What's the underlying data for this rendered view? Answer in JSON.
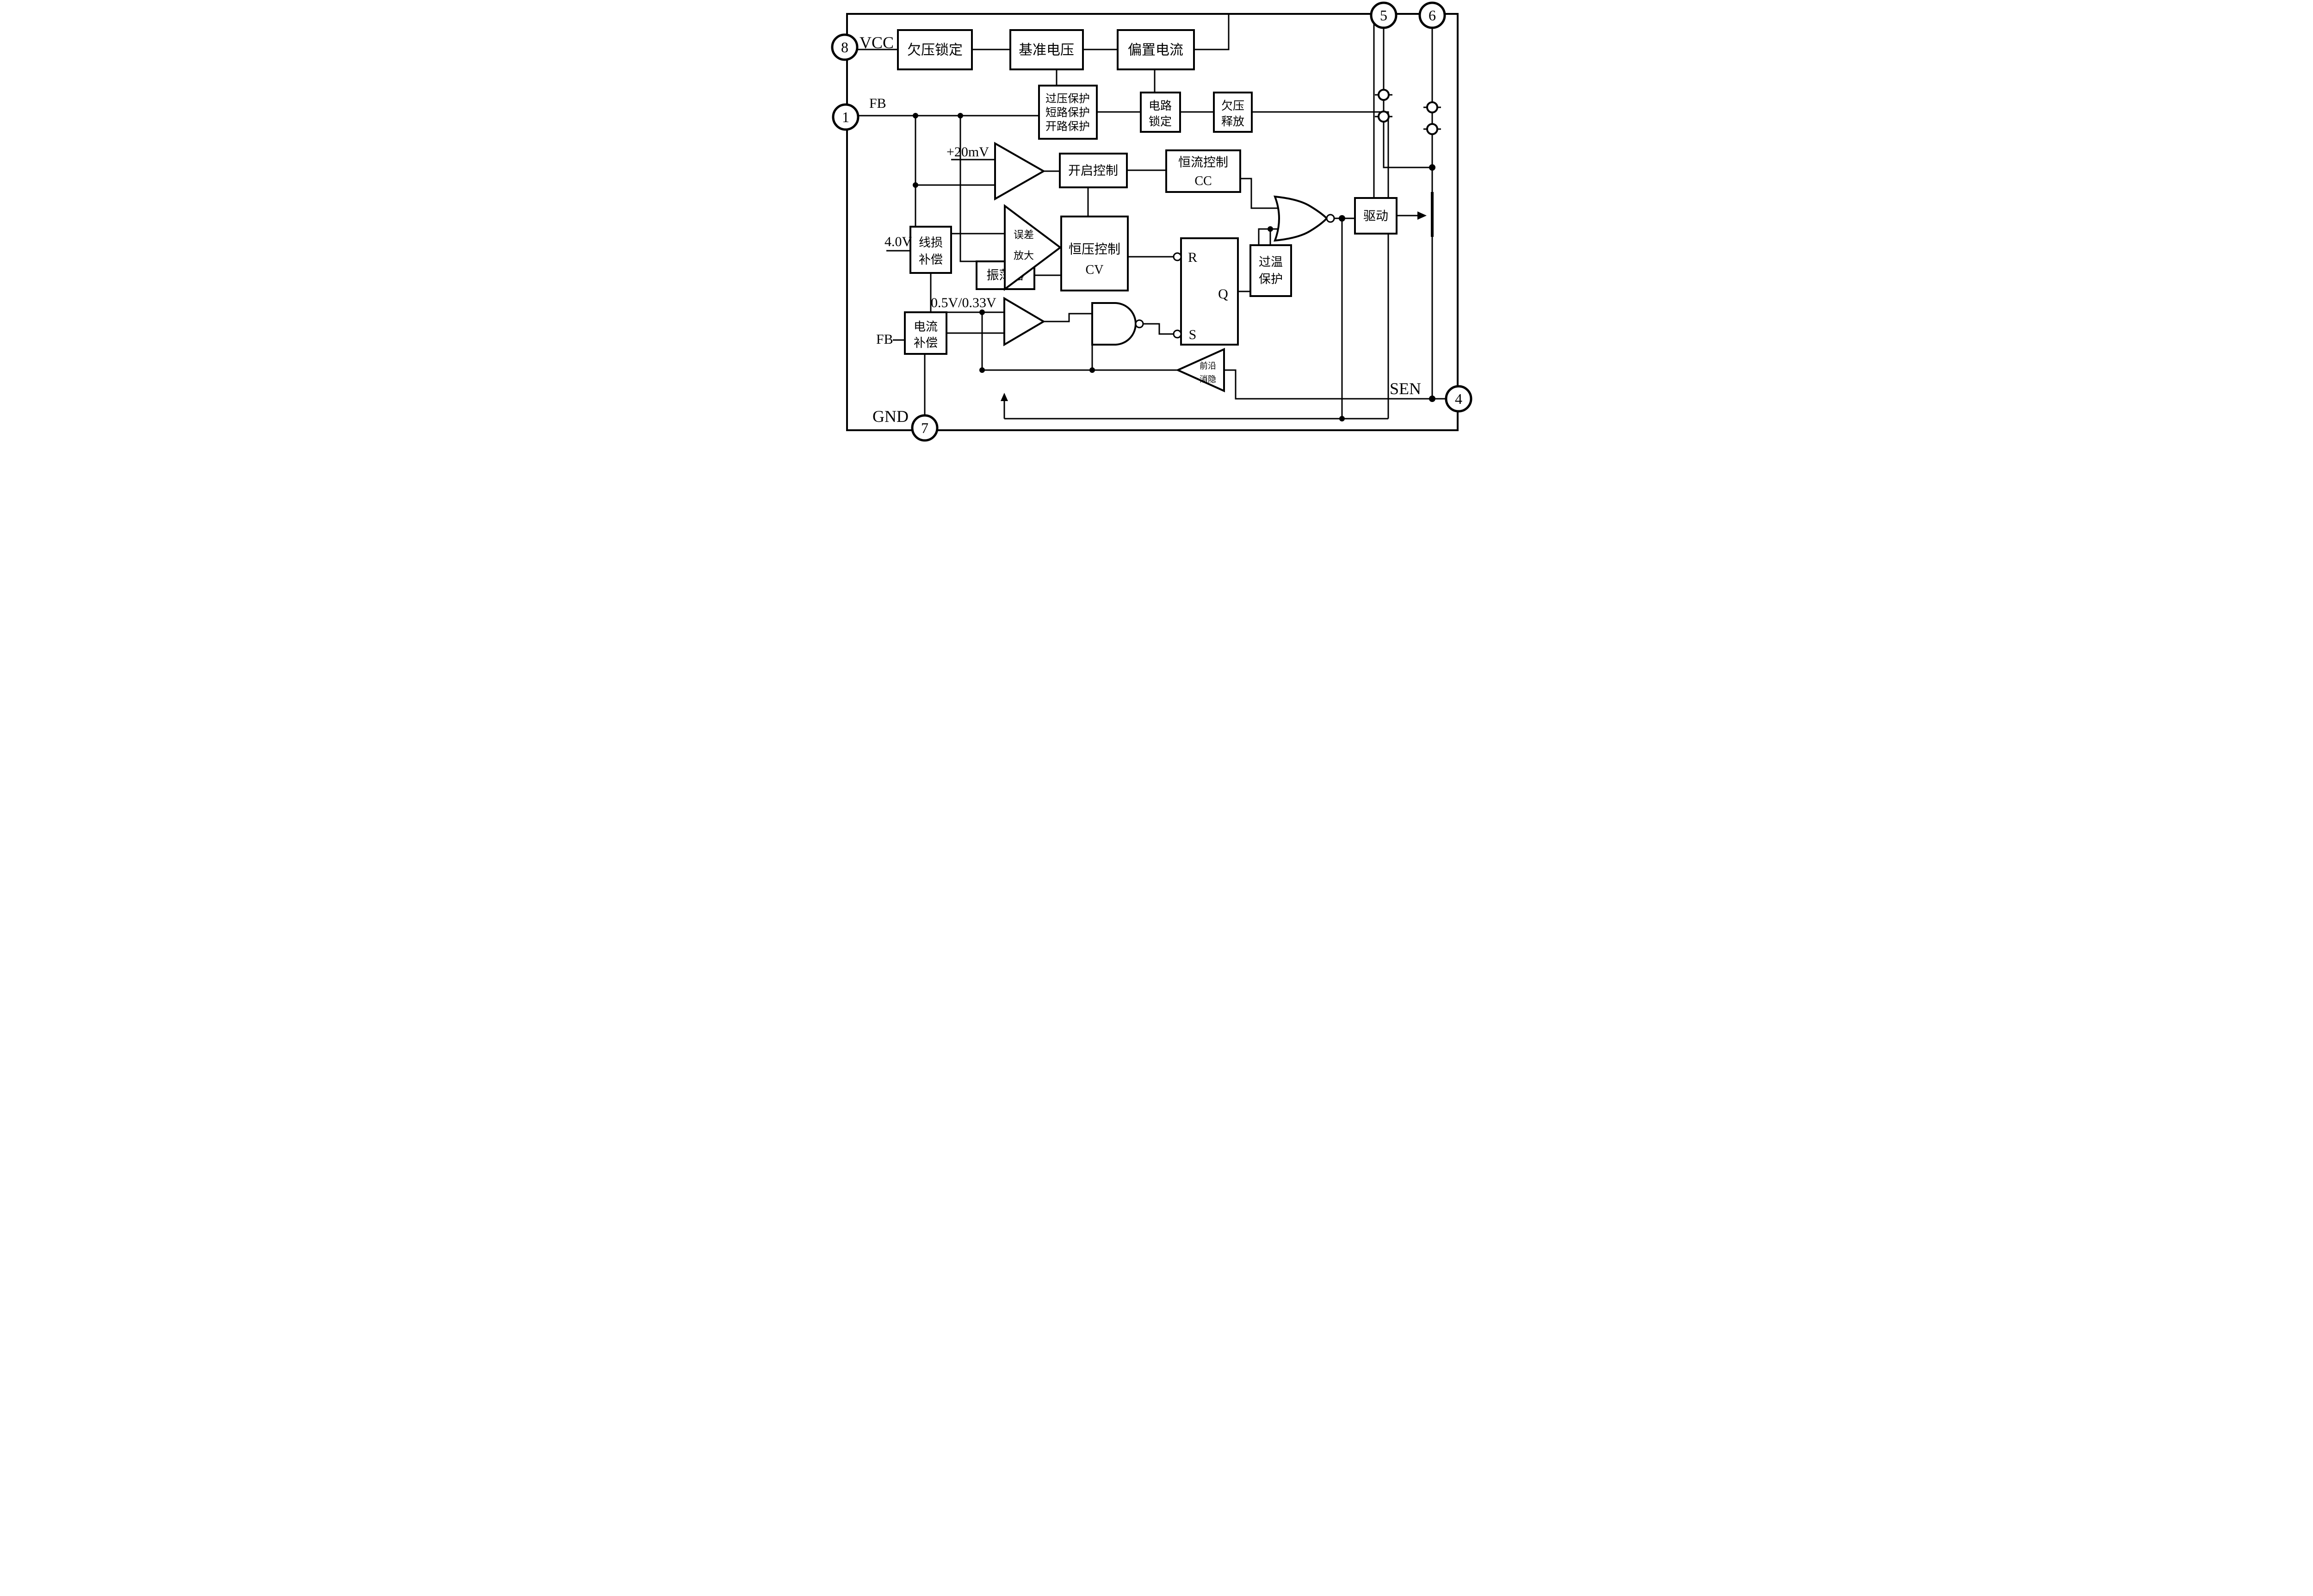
{
  "diagram": {
    "title_hint": "IC functional block diagram",
    "colors": {
      "line": "#000000",
      "background": "#ffffff"
    },
    "blocks": {
      "uvlo": {
        "label": "欠压锁定"
      },
      "vref": {
        "label": "基准电压"
      },
      "bias": {
        "label": "偏置电流"
      },
      "protection": {
        "line1": "过压保护",
        "line2": "短路保护",
        "line3": "开路保护"
      },
      "latch": {
        "line1": "电路",
        "line2": "锁定"
      },
      "uv_release": {
        "line1": "欠压",
        "line2": "释放"
      },
      "on_control": {
        "label": "开启控制"
      },
      "cc_control": {
        "line1": "恒流控制",
        "line2": "CC"
      },
      "error_amp": {
        "line1": "误差",
        "line2": "放大"
      },
      "cv_control": {
        "line1": "恒压控制",
        "line2": "CV"
      },
      "line_loss": {
        "line1": "线损",
        "line2": "补偿"
      },
      "oscillator": {
        "label": "振荡器"
      },
      "current_comp": {
        "line1": "电流",
        "line2": "补偿"
      },
      "leb": {
        "line1": "前沿",
        "line2": "消隐"
      },
      "otp": {
        "line1": "过温",
        "line2": "保护"
      },
      "driver": {
        "label": "驱动"
      }
    },
    "flipflop": {
      "r": "R",
      "s": "S",
      "q": "Q"
    },
    "pins": {
      "vcc": {
        "number": "8",
        "label": "VCC"
      },
      "fb": {
        "number": "1",
        "label": "FB"
      },
      "gnd": {
        "number": "7",
        "label": "GND"
      },
      "sen": {
        "number": "4",
        "label": "SEN"
      },
      "drain5": {
        "number": "5"
      },
      "drain6": {
        "number": "6"
      }
    },
    "net_labels": {
      "ref_20mv": "+20mV",
      "ref_4v": "4.0V",
      "ref_05_033": "0.5V/0.33V",
      "fb_net": "FB"
    }
  }
}
